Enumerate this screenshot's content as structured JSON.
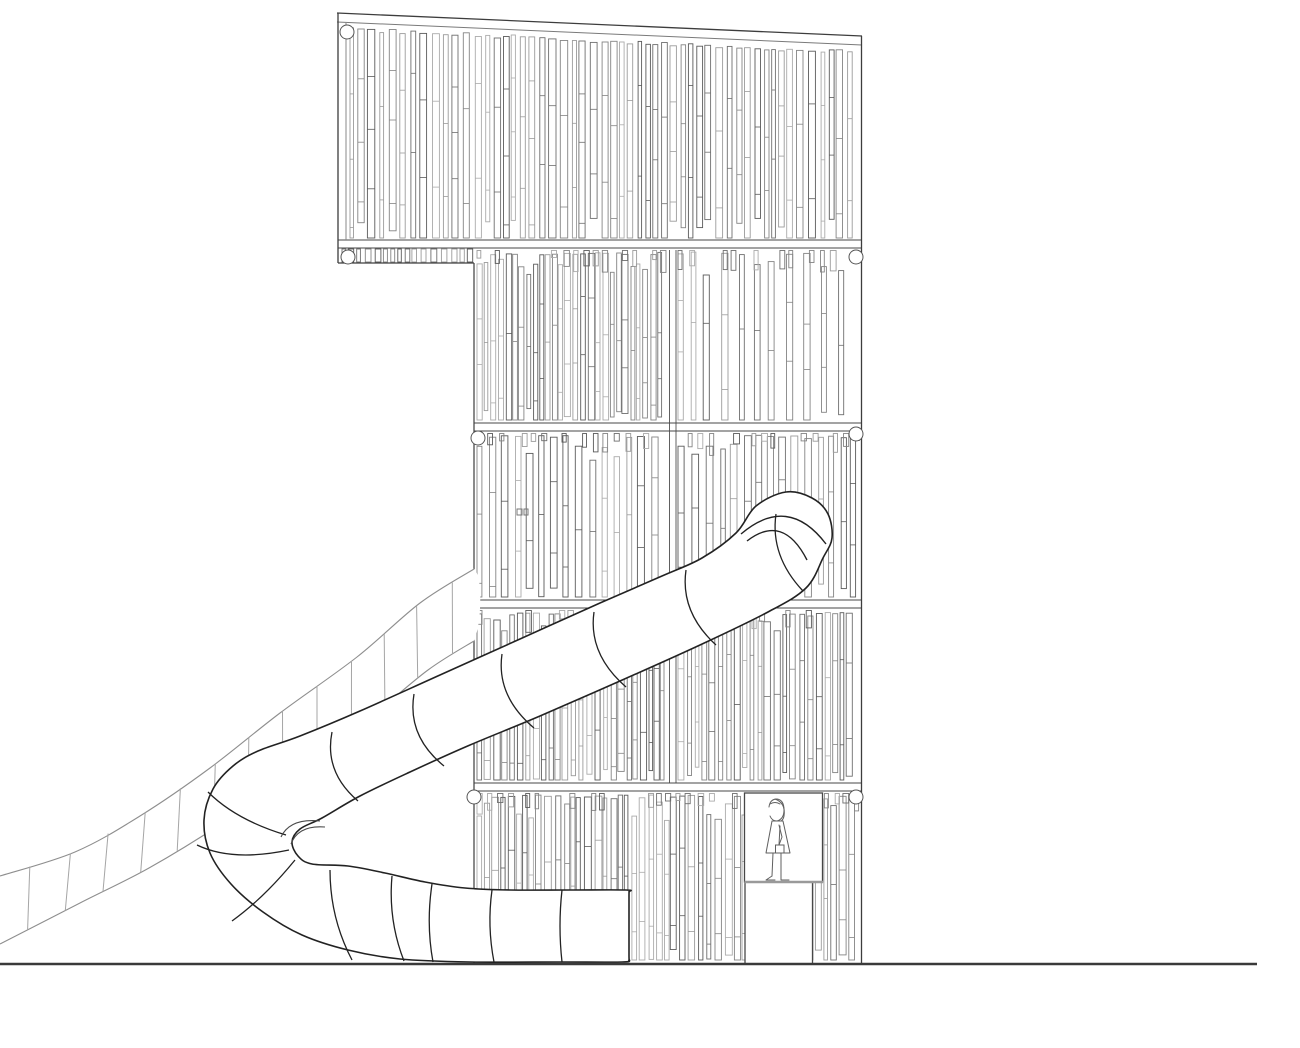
{
  "canvas": {
    "width": 1300,
    "height": 1048,
    "background": "#ffffff"
  },
  "colors": {
    "edge": "#3d3d3d",
    "rail": "#474747",
    "slat_palette": [
      "#5a5a5a",
      "#6e6e6e",
      "#848484",
      "#9b9b9b",
      "#ababab"
    ],
    "tube_line": "#222222",
    "slide_line": "#8e8e8e",
    "rung_line": "#a5a5a5",
    "ground": "#3a3a3a",
    "figure": "#5f5f5f",
    "circle": "#555555",
    "white": "#ffffff"
  },
  "seed": 7,
  "tower": {
    "top_line1": [
      [
        337,
        13
      ],
      [
        862,
        36
      ]
    ],
    "top_line2": [
      [
        337,
        22
      ],
      [
        862,
        45
      ]
    ],
    "left_edge_upper": {
      "x": 338,
      "y0": 13,
      "y1": 263
    },
    "left_edge_upper_inner": {
      "x": 346,
      "y0": 22,
      "y1": 240
    },
    "left_edge_lower": {
      "x": 474,
      "y0": 263,
      "y1": 963
    },
    "right_edge": {
      "x": 861.5,
      "y0": 36,
      "y1": 963
    },
    "step_line": {
      "y": 263,
      "x0": 338,
      "x1": 474
    },
    "rails": [
      {
        "y1": 240,
        "y2": 248,
        "x0": 338,
        "x1": 861.5
      },
      {
        "y1": 423,
        "y2": 431,
        "x0": 474,
        "x1": 861.5
      },
      {
        "y1": 600,
        "y2": 608,
        "x0": 474,
        "x1": 861.5
      },
      {
        "y1": 783,
        "y2": 791,
        "x0": 474,
        "x1": 861.5
      }
    ],
    "seam": {
      "x1": 669.5,
      "x2": 676,
      "y0": 250,
      "y1": 783
    },
    "corner_circles": [
      [
        347,
        32
      ],
      [
        348,
        257
      ],
      [
        478,
        438
      ],
      [
        856,
        257
      ],
      [
        856,
        434
      ],
      [
        474,
        797
      ],
      [
        856,
        797
      ]
    ],
    "latch_marks": [
      [
        517,
        509,
        5,
        6
      ],
      [
        524,
        509,
        4,
        6
      ]
    ],
    "slope_band": {
      "x0": 350,
      "x1": 858,
      "m": 0.0456,
      "xref": 337,
      "ytop": 27,
      "bottom": 238,
      "gap": [
        2,
        6
      ],
      "w": [
        3.5,
        7.5
      ]
    },
    "rail_stub_row": {
      "x0": 342,
      "x1": 472,
      "top": 249,
      "bottom": 262,
      "gap": [
        2,
        5
      ],
      "w": [
        3.5,
        6
      ]
    },
    "bands": [
      {
        "x0": 477,
        "x1": 667,
        "top": 250,
        "bottom": 421,
        "gap": [
          0.5,
          3.5
        ],
        "w": [
          3.5,
          6.5
        ],
        "stubs": true
      },
      {
        "x0": 678,
        "x1": 858,
        "top": 250,
        "bottom": 421,
        "gap": [
          7,
          14
        ],
        "w": [
          4.5,
          7
        ],
        "stubs": true
      },
      {
        "x0": 477,
        "x1": 667,
        "top": 433,
        "bottom": 598,
        "gap": [
          5,
          9
        ],
        "w": [
          4.5,
          7
        ],
        "stubs": true
      },
      {
        "x0": 678,
        "x1": 858,
        "top": 433,
        "bottom": 598,
        "gap": [
          4,
          8
        ],
        "w": [
          4.5,
          7
        ],
        "stubs": true
      },
      {
        "x0": 477,
        "x1": 667,
        "top": 610,
        "bottom": 781,
        "gap": [
          1,
          4
        ],
        "w": [
          3.5,
          6.5
        ],
        "stubs": true
      },
      {
        "x0": 678,
        "x1": 858,
        "top": 610,
        "bottom": 781,
        "gap": [
          2,
          5
        ],
        "w": [
          3.5,
          6.5
        ],
        "stubs": true
      },
      {
        "x0": 477,
        "x1": 858,
        "top": 793,
        "bottom": 961,
        "gap": [
          1,
          4.5
        ],
        "w": [
          3.5,
          7
        ],
        "stubs": true
      }
    ]
  },
  "door": {
    "window": {
      "x": 744.5,
      "y": 793,
      "w": 78,
      "h": 89
    },
    "sill": {
      "x0": 744.5,
      "x1": 823,
      "y": 882
    },
    "doorway": {
      "x": 745,
      "y": 882,
      "w": 67.5,
      "h": 81
    }
  },
  "figure": {
    "paths": [
      "M769,807 Q770,799 777,799 Q784,800 784,810 Q784,819 777,821 Q772,821 770,816",
      "M775,799 Q786,803 784,816 Q783,822 776,823",
      "M770,804 Q775,801 780,804",
      "M772,821 L766,853 L790,853 L783,821 Z",
      "M779,825 L782,837 L779,845",
      "M780,826 L779,845",
      "M773,853 L772,876",
      "M781,853 L781,876",
      "M772,876 L766,880 L775,880",
      "M781,876 L781,880 L789,880"
    ],
    "bag": {
      "x": 775.5,
      "y": 845,
      "w": 8.5,
      "h": 8
    }
  },
  "slide": {
    "top_edge": [
      [
        474,
        569
      ],
      [
        420,
        603
      ],
      [
        357,
        657
      ],
      [
        280,
        713
      ],
      [
        210,
        768
      ],
      [
        140,
        816
      ],
      [
        75,
        852
      ],
      [
        0,
        876
      ]
    ],
    "bottom_edge": [
      [
        474,
        641
      ],
      [
        428,
        670
      ],
      [
        368,
        719
      ],
      [
        293,
        773
      ],
      [
        221,
        824
      ],
      [
        149,
        868
      ],
      [
        80,
        903
      ],
      [
        0,
        944
      ]
    ],
    "rung_count": 13
  },
  "tube": {
    "outline": [
      [
        736,
        533
      ],
      [
        756,
        506
      ],
      [
        786,
        492
      ],
      [
        812,
        498
      ],
      [
        828,
        514
      ],
      [
        832,
        538
      ],
      [
        823,
        558
      ],
      [
        806,
        588
      ],
      [
        768,
        612
      ],
      [
        700,
        645
      ],
      [
        620,
        681
      ],
      [
        540,
        716
      ],
      [
        470,
        745
      ],
      [
        410,
        772
      ],
      [
        360,
        796
      ],
      [
        322,
        818
      ],
      [
        300,
        829
      ],
      [
        292,
        842
      ],
      [
        298,
        856
      ],
      [
        312,
        864
      ],
      [
        348,
        866
      ],
      [
        385,
        873
      ],
      [
        425,
        882
      ],
      [
        465,
        888
      ],
      [
        510,
        890
      ],
      [
        570,
        890
      ],
      [
        626,
        890
      ],
      [
        629,
        892
      ],
      [
        629,
        897
      ],
      [
        629,
        955
      ],
      [
        629,
        960
      ],
      [
        622,
        962
      ],
      [
        560,
        962
      ],
      [
        470,
        962
      ],
      [
        400,
        959
      ],
      [
        348,
        950
      ],
      [
        302,
        935
      ],
      [
        263,
        912
      ],
      [
        231,
        884
      ],
      [
        210,
        853
      ],
      [
        204,
        820
      ],
      [
        213,
        789
      ],
      [
        233,
        766
      ],
      [
        258,
        751
      ],
      [
        300,
        736
      ],
      [
        360,
        711
      ],
      [
        440,
        675
      ],
      [
        520,
        639
      ],
      [
        600,
        603
      ],
      [
        662,
        576
      ],
      [
        702,
        558
      ]
    ],
    "rings": [
      [
        [
          776,
          514
        ],
        [
          770,
          556
        ],
        [
          803,
          591
        ]
      ],
      [
        [
          686,
          570
        ],
        [
          680,
          612
        ],
        [
          716,
          645
        ]
      ],
      [
        [
          594,
          612
        ],
        [
          588,
          654
        ],
        [
          626,
          687
        ]
      ],
      [
        [
          502,
          654
        ],
        [
          496,
          696
        ],
        [
          534,
          728
        ]
      ],
      [
        [
          414,
          694
        ],
        [
          407,
          736
        ],
        [
          444,
          766
        ]
      ],
      [
        [
          332,
          732
        ],
        [
          324,
          772
        ],
        [
          358,
          801
        ]
      ],
      [
        [
          208,
          792
        ],
        [
          236,
          820
        ],
        [
          286,
          835
        ]
      ],
      [
        [
          197,
          845
        ],
        [
          232,
          862
        ],
        [
          289,
          850
        ]
      ],
      [
        [
          232,
          921
        ],
        [
          264,
          898
        ],
        [
          295,
          860
        ]
      ],
      [
        [
          330,
          870
        ],
        [
          330,
          918
        ],
        [
          352,
          960
        ]
      ],
      [
        [
          392,
          876
        ],
        [
          388,
          920
        ],
        [
          404,
          961
        ]
      ],
      [
        [
          432,
          884
        ],
        [
          426,
          924
        ],
        [
          433,
          962
        ]
      ],
      [
        [
          492,
          890
        ],
        [
          487,
          926
        ],
        [
          494,
          962
        ]
      ],
      [
        [
          562,
          890
        ],
        [
          558,
          926
        ],
        [
          562,
          962
        ]
      ]
    ],
    "elbow_arcs": [
      "M741,534 Q788,494 826,544",
      "M747,541 Q783,513 807,560"
    ],
    "curl_arcs": [
      "M320,821 Q290,818 281,837",
      "M325,827 Q298,825 291,844"
    ]
  },
  "ground": {
    "y": 964,
    "x0": 0,
    "x1": 1257
  }
}
